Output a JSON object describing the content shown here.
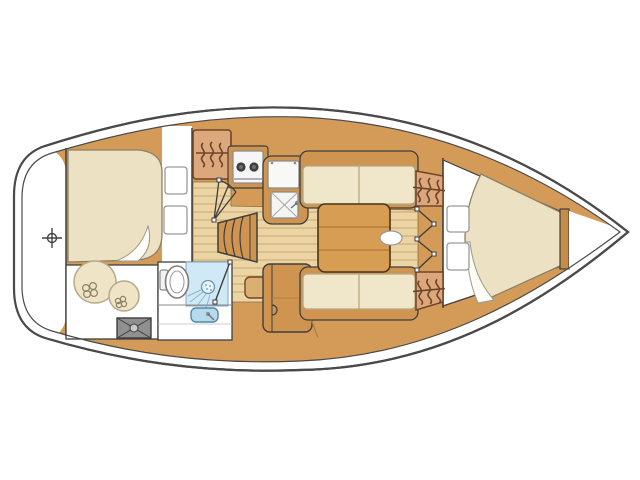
{
  "diagram": {
    "kind": "sailboat-interior-floor-plan",
    "visible_text": "",
    "orientation": "bow-right-stern-left"
  },
  "palette": {
    "background": "#ffffff",
    "outline": "#4a4a4a",
    "line_dark": "#3f3f3f",
    "wood": "#d49b58",
    "wood_dark": "#cf9450",
    "wood_trim": "#c58c45",
    "floor": "#ecd4a4",
    "plank_line": "#c9a96b",
    "cushion": "#f0e7ca",
    "cushion_edge": "#b3a67f",
    "berth": "#ece1c2",
    "locker": "#dca77c",
    "locker_icon": "#6e4526",
    "pillow": "#ffffff",
    "pillow_edge": "#9a9a9a",
    "shower": "#cfe9f7",
    "shower_line": "#7fa8c4",
    "sink_blue": "#b5d9ed",
    "sink_edge": "#5588aa",
    "hatch_gray": "#909090",
    "stove_white": "#f6f6f6",
    "burner": "#3f3f3f",
    "fender": "#efe4c6",
    "fender_edge": "#b5a98a",
    "table_wood": "#d79d52"
  },
  "icons": [
    "crosshair-icon",
    "clothes-hanger-icon",
    "stove-burner-icon",
    "sink-drain-x-icon",
    "shower-head-icon",
    "door-swing-icon",
    "hatch-cross-icon"
  ],
  "fixtures": [
    "aft-double-berth",
    "aft-berth-pillows",
    "storage-fenders",
    "deck-hatch",
    "head-toilet",
    "head-shower",
    "head-sink",
    "galley-hanging-locker",
    "galley-stove",
    "galley-icebox",
    "galley-sink",
    "companionway-steps",
    "aft-cabin-door",
    "head-door",
    "salon-table",
    "salon-settee-port",
    "salon-settee-starboard",
    "nav-cabinet",
    "stool",
    "forward-cabin-doors",
    "forward-hanging-lockers",
    "forward-vberth",
    "forward-berth-pillows",
    "bow-crosshair-marker"
  ]
}
